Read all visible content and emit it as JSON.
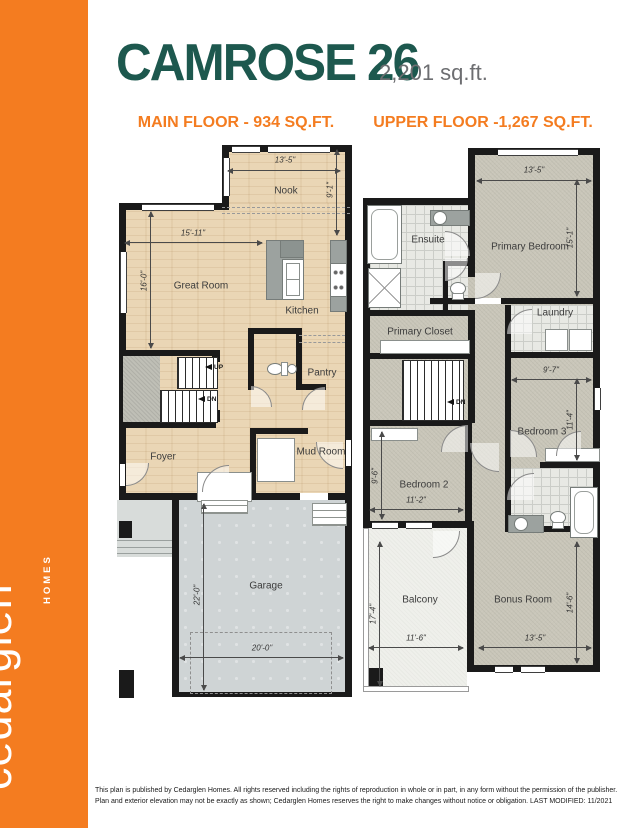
{
  "sidebar": {
    "brand": "cedarglen",
    "brand_sub": "HOMES",
    "color": "#F47C20"
  },
  "header": {
    "title": "CAMROSE 26",
    "total_sqft": "2,201 sq.ft.",
    "title_color": "#1D584E",
    "accent_color": "#F47C20"
  },
  "plans": {
    "main": {
      "heading": "MAIN FLOOR - 934 SQ.FT.",
      "rooms": {
        "nook": "Nook",
        "great_room": "Great Room",
        "kitchen": "Kitchen",
        "pantry": "Pantry",
        "foyer": "Foyer",
        "mud_room": "Mud Room",
        "garage": "Garage"
      },
      "stairs": {
        "up": "UP",
        "down": "DN"
      },
      "dims": {
        "nook_w": "13'-5\"",
        "nook_h": "9'-1\"",
        "great_w": "15'-11\"",
        "great_h": "16'-0\"",
        "garage_h": "22'-0\"",
        "garage_w": "20'-0\""
      }
    },
    "upper": {
      "heading": "UPPER FLOOR -1,267 SQ.FT.",
      "rooms": {
        "ensuite": "Ensuite",
        "primary_bedroom": "Primary Bedroom",
        "primary_closet": "Primary Closet",
        "laundry": "Laundry",
        "bedroom3": "Bedroom 3",
        "bedroom2": "Bedroom 2",
        "balcony": "Balcony",
        "bonus": "Bonus Room"
      },
      "stairs": {
        "down": "DN"
      },
      "dims": {
        "primary_w": "13'-5\"",
        "primary_h": "15'-1\"",
        "bed3_w": "9'-7\"",
        "bed3_h": "11'-4\"",
        "bed2_w": "11'-2\"",
        "bed2_h": "9'-6\"",
        "balcony_h": "17'-4\"",
        "balcony_w": "11'-6\"",
        "bonus_w": "13'-5\"",
        "bonus_h": "14'-6\""
      }
    }
  },
  "footer": {
    "line1": "This plan is published by Cedarglen Homes.  All rights reserved including the rights of reproduction in whole or in part, in any form without the permission of the publisher.",
    "line2": "Plan and exterior elevation may not be exactly as shown; Cedarglen Homes reserves the right to make changes without notice or obligation.  LAST MODIFIED: 11/2021"
  }
}
